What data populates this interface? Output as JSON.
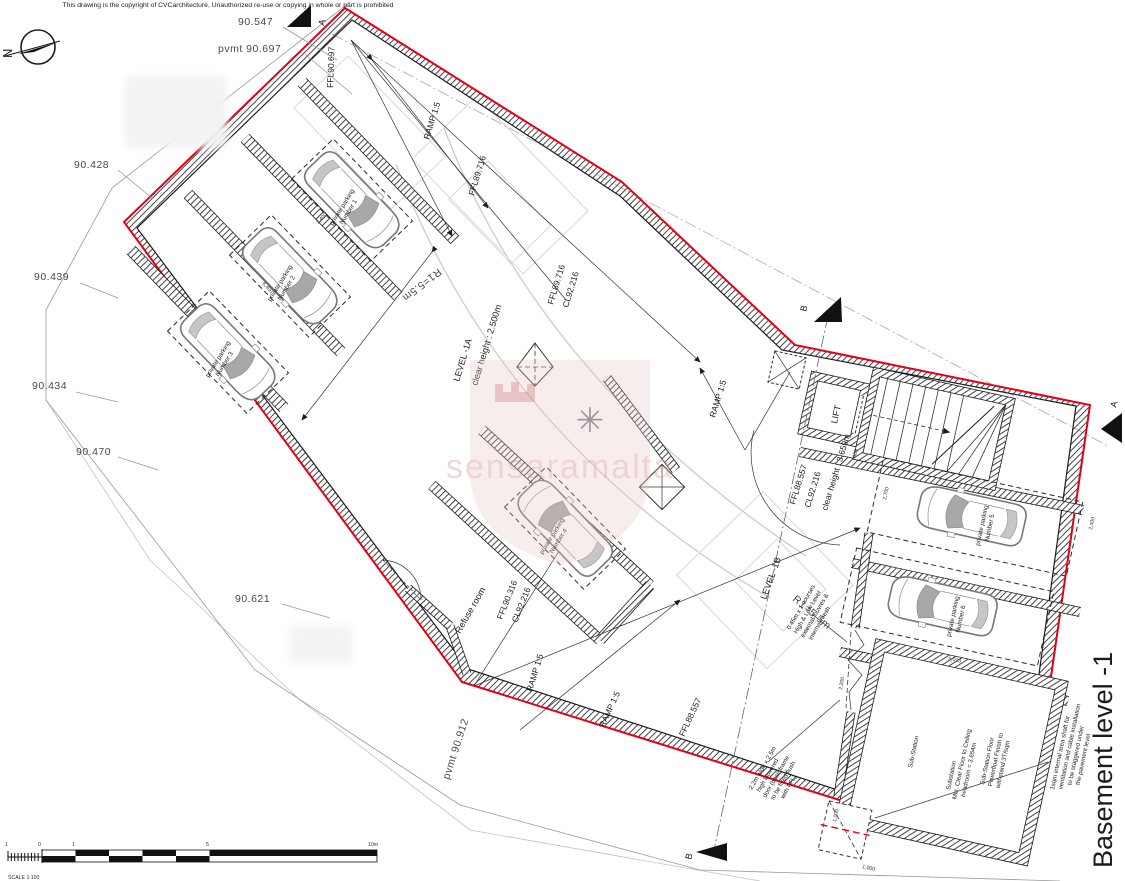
{
  "copyright": "This drawing is the copyright of CVCarchitecture, Unauthorized re-use or copying in whole or part is prohibited",
  "title": "Basement level -1",
  "north_label": "N",
  "watermark": {
    "text": "sensaramalta"
  },
  "scale_bar": {
    "ticks": [
      "1",
      "0",
      "1",
      "5",
      "10m"
    ],
    "caption": "SCALE 1:100"
  },
  "section_markers": {
    "a": "A",
    "b": "B"
  },
  "spot_levels": {
    "l90547": "90.547",
    "pvmt90697": "pvmt 90.697",
    "l90428": "90.428",
    "l90439": "90.439",
    "l90434": "90.434",
    "l90470": "90.470",
    "l90621": "90.621",
    "pvmt90912": "pvmt 90.912"
  },
  "ffl_labels": {
    "entry": "FFL90.697",
    "ramp_top": "FFL89.716",
    "l1a_ffl": "FFL89.716",
    "l1a_cl": "CL92.216",
    "refuse_ffl": "FFL90.316",
    "refuse_cl": "CL92.216",
    "ramp_bottom": "FFL88.557"
  },
  "levels": {
    "level1a": {
      "name": "LEVEL -1A",
      "clear_height": "clear height : 2.500m"
    },
    "level1b": {
      "name": "LEVEL -1B",
      "ffl": "FFL88.557",
      "cl": "CL92.216",
      "clear_height": "clear height : 3.659m"
    }
  },
  "ramp_label": "RAMP 1:5",
  "arc_label": "R1=5.5m",
  "rooms": {
    "lift": "LIFT",
    "refuse": "Refuse room",
    "substation": "Sub-Station"
  },
  "parking": {
    "prefix": "private parking",
    "spaces": [
      "Number 1",
      "Number 2",
      "Number 3",
      "Number 4",
      "Number 5",
      "Number 6"
    ]
  },
  "notes": {
    "substation_headroom": {
      "lines": [
        "Substation",
        "Min. Clear Floor to Ceiling",
        "headroom = 3.654m"
      ]
    },
    "substation_floor": {
      "lines": [
        "Sub-Station Floor",
        "Powerfloat Finish to",
        "withstand 3T/sqm"
      ]
    },
    "vent_shaft": {
      "lines": [
        "1sqm internal area shaft for",
        "ventilation and cable installation",
        "to be staggered under",
        "the pavement level"
      ]
    },
    "louvres": {
      "lines": [
        "0.45m x 1 courses",
        "High & Low Level",
        "external louvres &",
        "internal mesh"
      ]
    },
    "louvered_door": {
      "lines": [
        "2.2m wide x 2.5m",
        "high louvered",
        "door (base frame",
        "to be fixed flush",
        "with FFL)"
      ]
    }
  },
  "dimensions": {
    "d2400": "2,400",
    "d6400": "6,400",
    "d2700": "2,700",
    "d5013": "5,013",
    "d1000": "1,000",
    "d600": "600",
    "d2200": "2,200"
  },
  "colors": {
    "boundary_red": "#e30016",
    "wall": "#1c1c1c",
    "watermark_pink": "#d89f9f"
  }
}
